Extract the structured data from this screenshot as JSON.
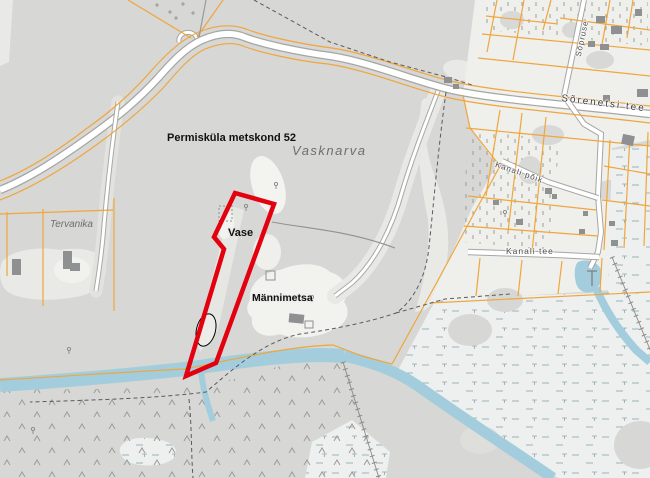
{
  "map": {
    "type": "cadastral-topographic-map",
    "place_labels": {
      "forest_compartment": "Permisküla metskond 52",
      "settlement": "Vasknarva",
      "property_vase": "Vase",
      "property_mannimetsa": "Männimetsa",
      "property_tervanika": "Tervanika"
    },
    "road_labels": {
      "main_road": "Sõrenetsi tee",
      "side_road": "Kanali põik",
      "canal_road": "Kanali tee",
      "village_street": "Sõpruse"
    },
    "highlight": {
      "description": "selected parcel outline",
      "color": "#e3000f"
    },
    "colors": {
      "forest": "#d7d7d5",
      "clearing": "#e9eae6",
      "open_light": "#f2f2ef",
      "village_block": "#efefec",
      "marsh": "#edf0ef",
      "water": "#a3cddd",
      "road_fill": "#ffffff",
      "road_casing": "#a6a6a4",
      "cadastral_line": "#efa63c",
      "building": "#8f9092"
    }
  }
}
